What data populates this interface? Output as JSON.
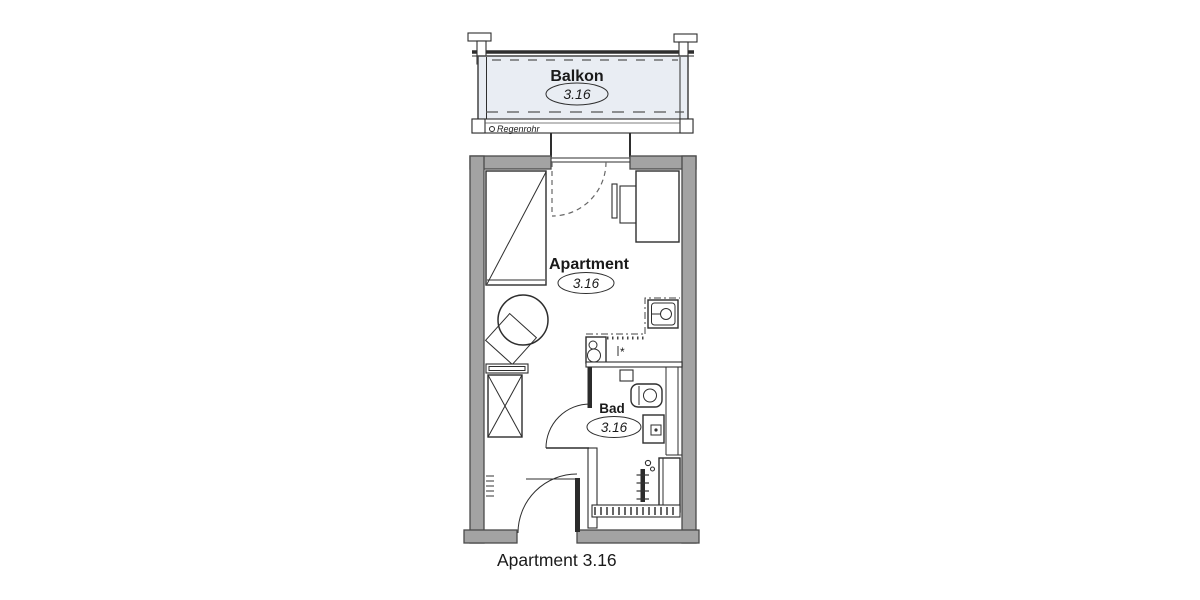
{
  "caption": "Apartment 3.16",
  "rooms": {
    "balcony": {
      "label": "Balkon",
      "number": "3.16"
    },
    "apartment": {
      "label": "Apartment",
      "number": "3.16"
    },
    "bathroom": {
      "label": "Bad",
      "number": "3.16"
    }
  },
  "annotations": {
    "rain_pipe": "Regenrohr",
    "kitchen_symbol": "*"
  },
  "colors": {
    "wall": "#a3a3a3",
    "wall_outline": "#4a4a4a",
    "line": "#2e2e2e",
    "balcony_fill": "#e9edf3",
    "fixture_dark": "#2b2b2b",
    "background": "#ffffff"
  }
}
